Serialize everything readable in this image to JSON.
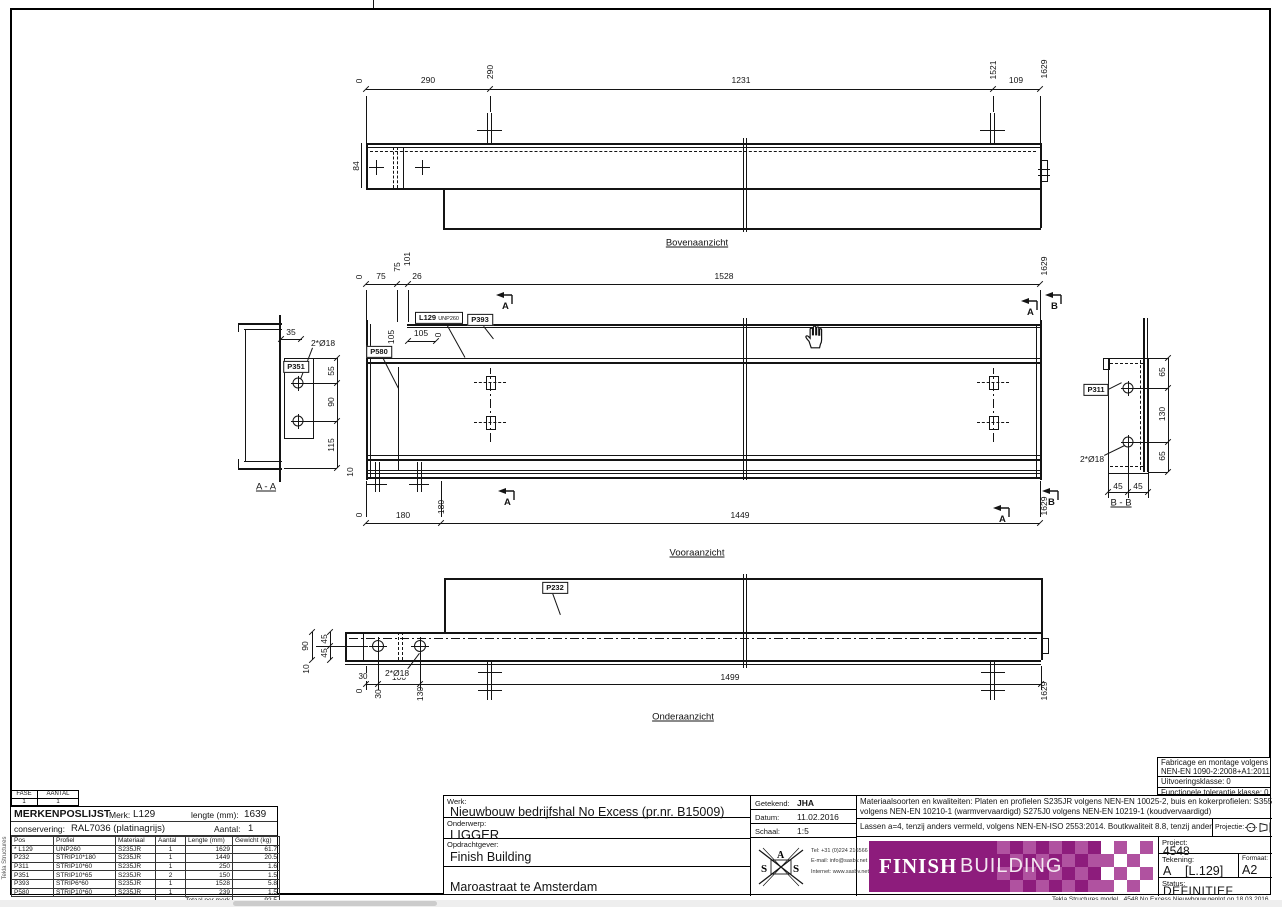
{
  "sheet": {
    "edge_text": "Tekla Structures",
    "footer": {
      "model": "Tekla Structures model",
      "file": "4548 No Excess Nieuwbouw",
      "plotted": "geplot op 18.03.2016"
    }
  },
  "views": {
    "sections": {
      "a": "A",
      "b": "B"
    },
    "top": {
      "title": "Bovenaanzicht",
      "dims": {
        "zero": "0",
        "w290": "290",
        "c290": "290",
        "w1231": "1231",
        "c1521": "1521",
        "w109": "109",
        "c1629": "1629",
        "h84": "84"
      }
    },
    "front": {
      "title": "Vooraanzicht",
      "dims": {
        "zero_top": "0",
        "w75": "75",
        "c75": "75",
        "c101": "101",
        "w26": "26",
        "w1528": "1528",
        "c1629_top": "1629",
        "c105": "105",
        "w105": "105",
        "zero_mid": "0",
        "c10": "10",
        "zero_bot": "0",
        "w180": "180",
        "c180": "180",
        "w1449": "1449",
        "c1629_bot": "1629"
      },
      "marks": {
        "l129": "L129",
        "l129_prof": "UNP260",
        "p393": "P393",
        "p580": "P580"
      }
    },
    "bottom": {
      "title": "Onderaanzicht",
      "dims": {
        "c90": "90",
        "c45a": "45",
        "c45b": "45",
        "c10": "10",
        "w30": "30",
        "w100": "100",
        "w1499": "1499",
        "zero": "0",
        "c30": "30",
        "c130": "130",
        "c1629": "1629",
        "holes": "2*Ø18"
      },
      "marks": {
        "p232": "P232"
      }
    },
    "aa": {
      "title": "A - A",
      "dims": {
        "w35": "35",
        "holes": "2*Ø18",
        "c55": "55",
        "c90": "90",
        "c115": "115"
      },
      "marks": {
        "p351": "P351"
      }
    },
    "bb": {
      "title": "B - B",
      "dims": {
        "c65a": "65",
        "c130": "130",
        "c65b": "65",
        "w45a": "45",
        "w45b": "45",
        "holes": "2*Ø18"
      },
      "marks": {
        "p311": "P311"
      }
    }
  },
  "parts": {
    "fase_label": "FASE",
    "fase": "1",
    "aantal_label": "AANTAL",
    "aantal": "1",
    "title": "MERKENPOSLIJST",
    "merk_label": "Merk:",
    "merk": "L129",
    "lengte_label": "lengte (mm):",
    "lengte": "1639",
    "conservering_label": "conservering:",
    "conservering": "RAL7036 (platinagrijs)",
    "aantal2_label": "Aantal:",
    "aantal2": "1",
    "columns": [
      "Pos",
      "Profiel",
      "Materiaal",
      "Aantal",
      "Lengte (mm)",
      "Gewicht (kg)"
    ],
    "rows": [
      [
        "* L129",
        "UNP260",
        "S235JR",
        "1",
        "1629",
        "61.7"
      ],
      [
        "P232",
        "STRIP10*180",
        "S235JR",
        "1",
        "1449",
        "20.5"
      ],
      [
        "P311",
        "STRIP10*60",
        "S235JR",
        "1",
        "250",
        "1.6"
      ],
      [
        "P351",
        "STRIP10*65",
        "S235JR",
        "2",
        "150",
        "1.5"
      ],
      [
        "P393",
        "STRIP6*60",
        "S235JR",
        "1",
        "1528",
        "5.8"
      ],
      [
        "P580",
        "STRIP10*60",
        "S235JR",
        "1",
        "239",
        "1.5"
      ]
    ],
    "total_label": "Totaal per merk",
    "total": "92.5"
  },
  "titleblock": {
    "werk_label": "Werk:",
    "werk": "Nieuwbouw bedrijfshal No Excess (pr.nr. B15009)",
    "onderwerp_label": "Onderwerp:",
    "onderwerp": "LIGGER",
    "opdrachtgever_label": "Opdrachtgever:",
    "opdrachtgever": "Finish Building",
    "locatie": "Maroastraat te Amsterdam",
    "getekend_label": "Getekend:",
    "getekend": "JHA",
    "datum_label": "Datum:",
    "datum": "11.02.2016",
    "schaal_label": "Schaal:",
    "schaal": "1:5",
    "contact": {
      "tel": "Tel: +31 (0)224 216566",
      "email": "E-mail: info@sasbv.net",
      "web": "Internet: www.sasbv.net"
    },
    "materials_line1": "Materiaalsoorten en kwaliteiten: Platen en profielen S235JR volgens NEN-EN 10025-2, buis en kokerprofielen: S355J2H",
    "materials_line2": "volgens NEN-EN 10210-1 (warmvervaardigd) S275J0 volgens NEN-EN 10219-1 (koudvervaardigd)",
    "materials_line3": "Lassen a=4, tenzij anders vermeld, volgens NEN-EN-ISO 2553:2014. Boutkwaliteit 8.8, tenzij anders vermeld",
    "projectie_label": "Projectie:",
    "fabricage": [
      "Fabricage en montage volgens",
      "NEN-EN 1090-2:2008+A1:2011",
      "Uitvoeringsklasse: 0",
      "Functionele tolerantie klasse: 0"
    ],
    "project_label": "Project:",
    "project": "4548",
    "tekening_label": "Tekening:",
    "tekening_rev": "A",
    "tekening_mark": "[L.129]",
    "formaat_label": "Formaat:",
    "formaat": "A2",
    "status_label": "Status:",
    "status": "DEFINITIEF",
    "logo": {
      "brand_bold": "FINISH",
      "brand_light": "BUILDING"
    },
    "sas": {
      "s1": "S",
      "a": "A",
      "s2": "S"
    },
    "colors": {
      "brand_purple": "#8d1c7c",
      "brand_purple_light": "#b052a0"
    }
  }
}
